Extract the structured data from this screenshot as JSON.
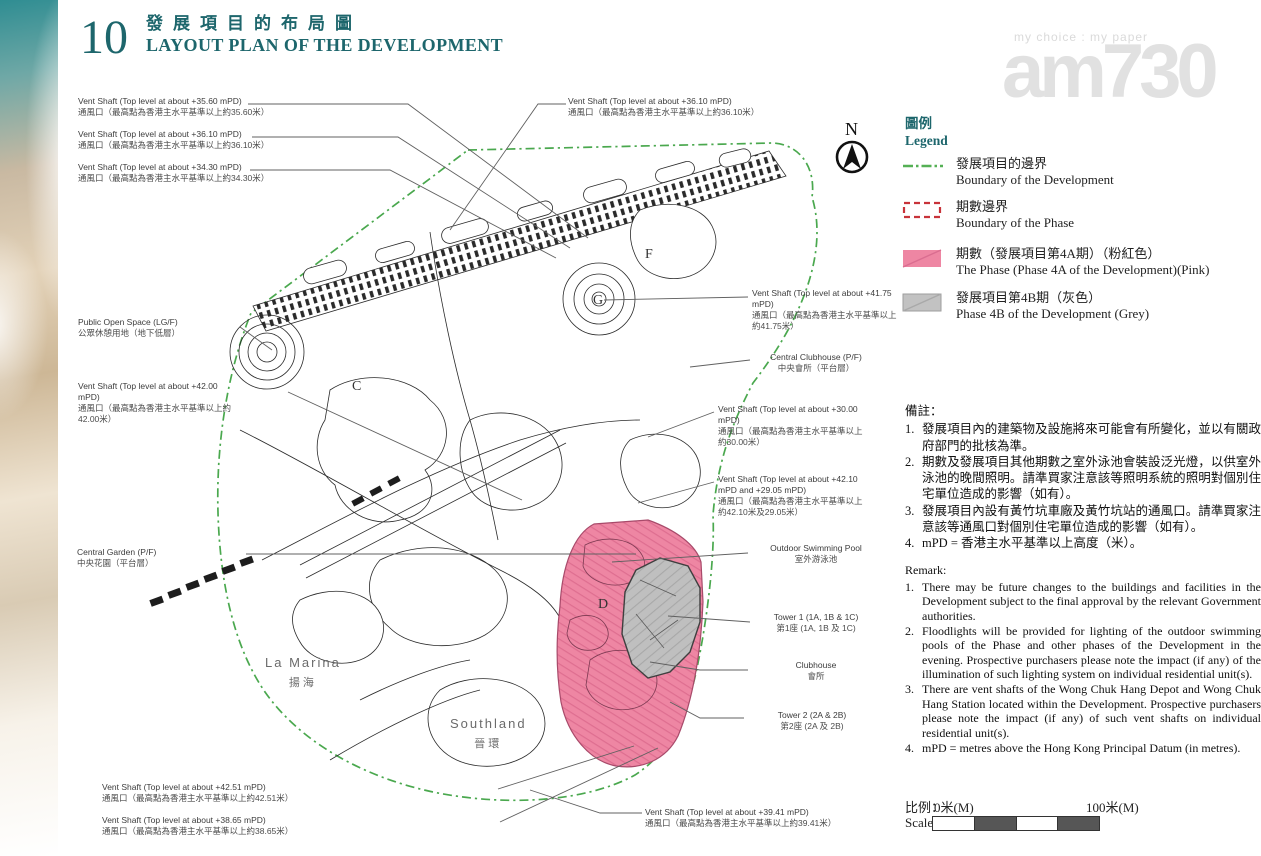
{
  "header": {
    "page_number": "10",
    "title_zh": "發展項目的布局圖",
    "title_en": "LAYOUT PLAN OF THE DEVELOPMENT"
  },
  "watermark": {
    "tagline": "my choice : my paper",
    "logo_text": "am730"
  },
  "compass": {
    "label": "N"
  },
  "legend": {
    "title_zh": "圖例",
    "title_en": "Legend",
    "colors": {
      "boundary_green": "#55b055",
      "phase_red": "#c8333a",
      "pink": "#ee86a3",
      "grey": "#c2c2c2"
    },
    "items": [
      {
        "zh": "發展項目的邊界",
        "en": "Boundary of the Development"
      },
      {
        "zh": "期數邊界",
        "en": "Boundary of the Phase"
      },
      {
        "zh": "期數（發展項目第4A期）（粉紅色）",
        "en": "The Phase (Phase 4A of the Development)(Pink)"
      },
      {
        "zh": "發展項目第4B期（灰色）",
        "en": "Phase 4B of the Development (Grey)"
      }
    ]
  },
  "remarks_zh": {
    "title": "備註：",
    "items": [
      {
        "num": "1.",
        "text": "發展項目內的建築物及設施將來可能會有所變化，並以有關政府部門的批核為準。"
      },
      {
        "num": "2.",
        "text": "期數及發展項目其他期數之室外泳池會裝設泛光燈，以供室外泳池的晚間照明。請準買家注意該等照明系統的照明對個別住宅單位造成的影響（如有）。"
      },
      {
        "num": "3.",
        "text": "發展項目內設有黃竹坑車廠及黃竹坑站的通風口。請準買家注意該等通風口對個別住宅單位造成的影響（如有）。"
      },
      {
        "num": "4.",
        "text": "mPD = 香港主水平基準以上高度（米）。"
      }
    ]
  },
  "remarks_en": {
    "title": "Remark:",
    "items": [
      {
        "num": "1.",
        "text": "There may be future changes to the buildings and facilities in the Development subject to the final approval by the relevant Government authorities."
      },
      {
        "num": "2.",
        "text": "Floodlights will be provided for lighting of the outdoor swimming pools of the Phase and other phases of the Development in the evening. Prospective purchasers please note the impact (if any) of the illumination of such lighting system on individual residential unit(s)."
      },
      {
        "num": "3.",
        "text": "There are vent shafts of the Wong Chuk Hang Depot and Wong Chuk Hang Station located within the Development. Prospective purchasers please note the impact (if any) of such vent shafts on individual residential unit(s)."
      },
      {
        "num": "4.",
        "text": "mPD = metres above the Hong Kong Principal Datum (in metres)."
      }
    ]
  },
  "scale": {
    "label_zh": "比例：",
    "label_en": "Scale:",
    "start": "0米(M)",
    "end": "100米(M)"
  },
  "callouts": [
    {
      "en": "Vent Shaft (Top level at about +35.60 mPD)",
      "zh": "通風口（最高點為香港主水平基準以上約35.60米）"
    },
    {
      "en": "Vent Shaft (Top level at about +36.10 mPD)",
      "zh": "通風口（最高點為香港主水平基準以上約36.10米）"
    },
    {
      "en": "Vent Shaft (Top level at about +34.30 mPD)",
      "zh": "通風口（最高點為香港主水平基準以上約34.30米）"
    },
    {
      "en": "Vent Shaft (Top level at about +36.10 mPD)",
      "zh": "通風口（最高點為香港主水平基準以上約36.10米）"
    },
    {
      "en": "Vent Shaft (Top level at about +41.75 mPD)",
      "zh": "通風口（最高點為香港主水平基準以上約41.75米）"
    },
    {
      "en": "Central Clubhouse (P/F)",
      "zh": "中央會所（平台層）"
    },
    {
      "en": "Vent Shaft (Top level at about +30.00 mPD)",
      "zh": "通風口（最高點為香港主水平基準以上約30.00米）"
    },
    {
      "en": "Vent Shaft (Top level at about +42.10 mPD and +29.05 mPD)",
      "zh": "通風口（最高點為香港主水平基準以上約42.10米及29.05米）"
    },
    {
      "en": "Outdoor Swimming Pool",
      "zh": "室外游泳池"
    },
    {
      "en": "Tower 1 (1A, 1B & 1C)",
      "zh": "第1座 (1A, 1B 及 1C)"
    },
    {
      "en": "Clubhouse",
      "zh": "會所"
    },
    {
      "en": "Tower 2 (2A & 2B)",
      "zh": "第2座 (2A 及 2B)"
    },
    {
      "en": "Public Open Space (LG/F)",
      "zh": "公眾休憩用地（地下低層）"
    },
    {
      "en": "Vent Shaft (Top level at about +42.00 mPD)",
      "zh": "通風口（最高點為香港主水平基準以上約42.00米）"
    },
    {
      "en": "Central Garden (P/F)",
      "zh": "中央花園（平台層）"
    },
    {
      "en": "Vent Shaft (Top level at about +42.51 mPD)",
      "zh": "通風口（最高點為香港主水平基準以上約42.51米）"
    },
    {
      "en": "Vent Shaft (Top level at about +38.65 mPD)",
      "zh": "通風口（最高點為香港主水平基準以上約38.65米）"
    },
    {
      "en": "Vent Shaft (Top level at about +39.41 mPD)",
      "zh": "通風口（最高點為香港主水平基準以上約39.41米）"
    }
  ],
  "map": {
    "markers": [
      {
        "label": "C"
      },
      {
        "label": "D"
      },
      {
        "label": "F"
      },
      {
        "label": "G"
      }
    ],
    "places": [
      {
        "en": "La Marina",
        "zh": "揚海"
      },
      {
        "en": "Southland",
        "zh": "晉環"
      }
    ]
  }
}
